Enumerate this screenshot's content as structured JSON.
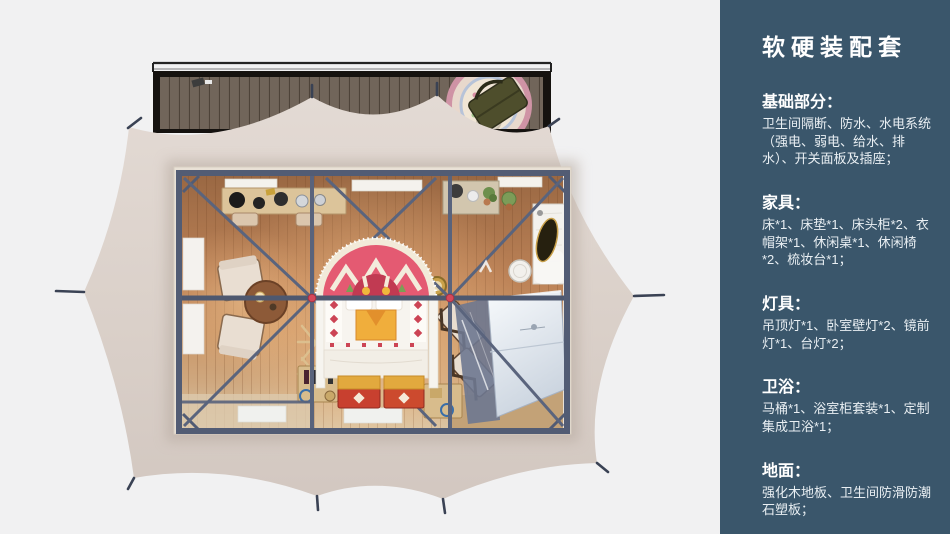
{
  "page": {
    "width": 950,
    "height": 534
  },
  "panel": {
    "title": "软硬装配套",
    "sections": [
      {
        "id": "basics",
        "heading": "基础部分：",
        "body": "卫生间隔断、防水、水电系统（强电、弱电、给水、排水）、开关面板及插座；"
      },
      {
        "id": "furniture",
        "heading": "家具：",
        "body": "床*1、床垫*1、床头柜*2、衣帽架*1、休闲桌*1、休闲椅*2、梳妆台*1；"
      },
      {
        "id": "lighting",
        "heading": "灯具：",
        "body": "吊顶灯*1、卧室壁灯*2、镜前灯*1、台灯*2；"
      },
      {
        "id": "bathroom",
        "heading": "卫浴：",
        "body": "马桶*1、浴室柜套装*1、定制集成卫浴*1；"
      },
      {
        "id": "flooring",
        "heading": "地面：",
        "body": "强化木地板、卫生间防滑防潮石塑板；"
      }
    ]
  },
  "floorplan": {
    "type": "top-down 3D render of a glamping tent suite with front deck",
    "colors": {
      "background": "#f1f1f2",
      "panel_background": "#3a566b",
      "panel_text": "#ffffff",
      "tent_canvas": "#dcd2cb",
      "steel_frame": "#59637c",
      "wood_floor": "#bb8156",
      "deck_wood": "#71655a",
      "rug_pink": "#e45a72",
      "bed_accent_red": "#cc4455",
      "chest_red": "#c8402f",
      "bathroom_white": "#e9eef4"
    }
  }
}
